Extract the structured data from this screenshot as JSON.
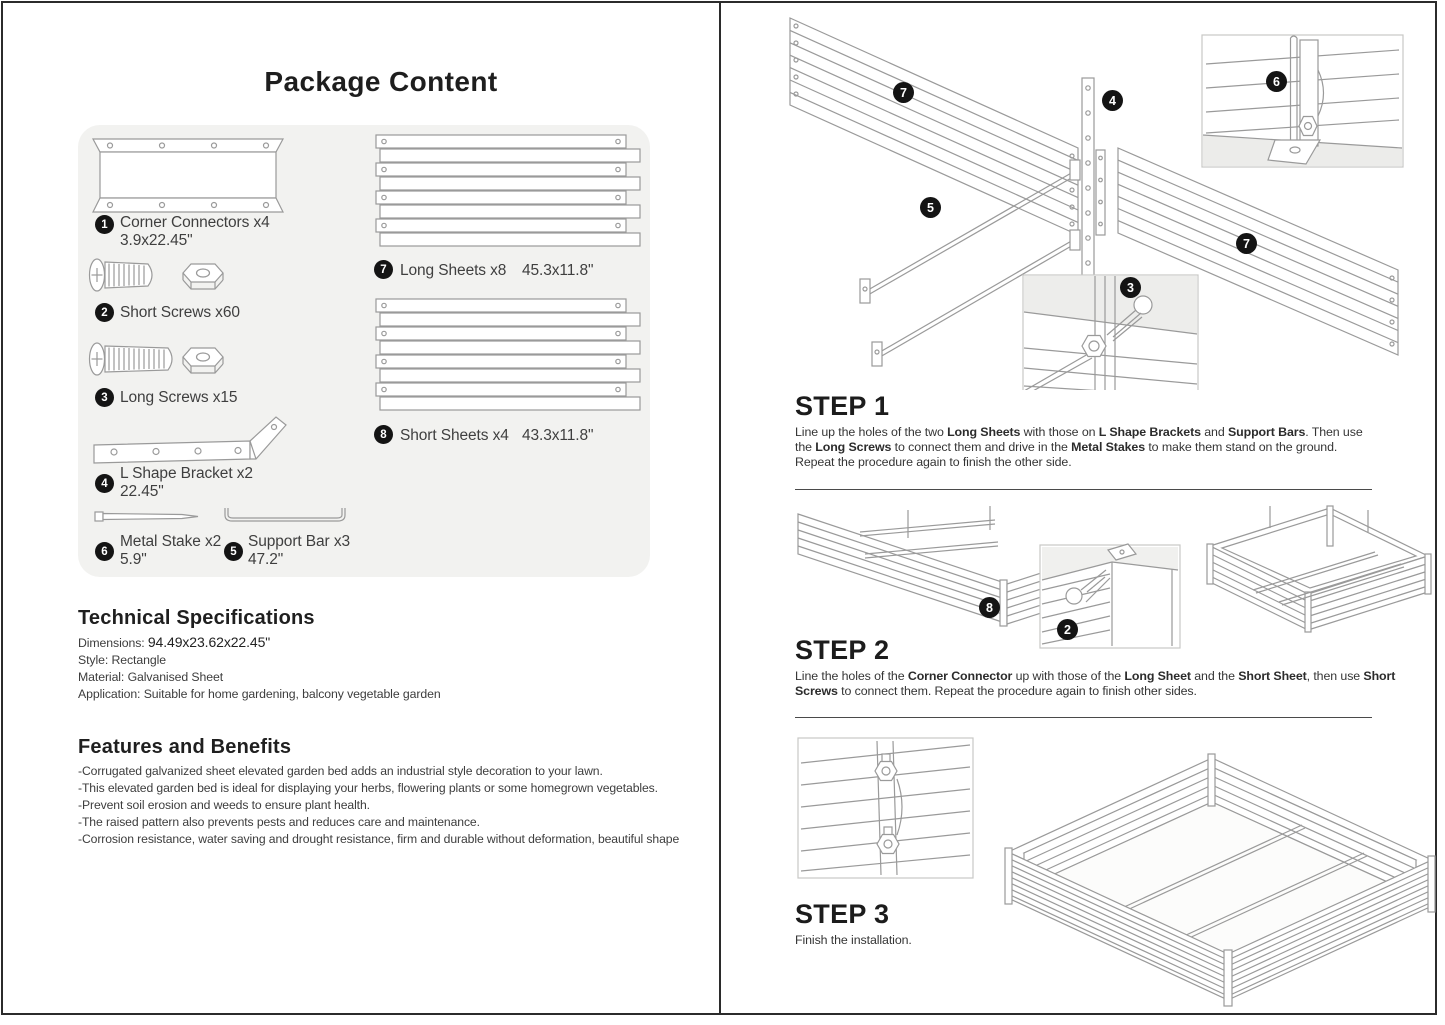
{
  "left": {
    "title": "Package Content",
    "package_items": {
      "i1": {
        "num": "1",
        "label": "Corner Connectors x4",
        "dim": "3.9x22.45\""
      },
      "i2": {
        "num": "2",
        "label": "Short Screws x60"
      },
      "i3": {
        "num": "3",
        "label": "Long Screws x15"
      },
      "i4": {
        "num": "4",
        "label": "L Shape Bracket x2",
        "dim": "22.45\""
      },
      "i5": {
        "num": "5",
        "label": "Support Bar x3",
        "dim": "47.2\""
      },
      "i6": {
        "num": "6",
        "label": "Metal Stake x2",
        "dim": "5.9\""
      },
      "i7": {
        "num": "7",
        "label": "Long Sheets x8",
        "dim": "45.3x11.8\""
      },
      "i8": {
        "num": "8",
        "label": "Short Sheets x4",
        "dim": "43.3x11.8\""
      }
    },
    "tech": {
      "heading": "Technical Specifications",
      "dimensions_label": "Dimensions: ",
      "dimensions_value": "94.49x23.62x22.45\"",
      "lines": [
        "Style: Rectangle",
        "Material: Galvanised Sheet",
        "Application: Suitable for home gardening, balcony vegetable garden"
      ]
    },
    "features": {
      "heading": "Features and Benefits",
      "bullets": [
        "-Corrugated galvanized sheet elevated garden bed adds an industrial style decoration to your lawn.",
        "-This elevated garden bed is ideal for displaying your herbs, flowering plants or some homegrown vegetables.",
        "-Prevent soil erosion and weeds to ensure plant health.",
        "-The raised pattern also prevents pests and reduces care and maintenance.",
        "-Corrosion resistance, water saving and drought resistance, firm and durable without deformation, beautiful shape"
      ]
    }
  },
  "right": {
    "step1": {
      "heading": "STEP 1",
      "body": [
        {
          "t": "Line up the holes of the two "
        },
        {
          "t": "Long Sheets",
          "b": true
        },
        {
          "t": " with those on "
        },
        {
          "t": "L Shape Brackets",
          "b": true
        },
        {
          "t": " and "
        },
        {
          "t": "Support Bars",
          "b": true
        },
        {
          "t": ". Then use the "
        },
        {
          "t": "Long Screws",
          "b": true
        },
        {
          "t": " to connect them and drive in the "
        },
        {
          "t": "Metal Stakes",
          "b": true
        },
        {
          "t": " to make them stand on the ground. Repeat the procedure again to finish the other side."
        }
      ]
    },
    "step2": {
      "heading": "STEP 2",
      "body": [
        {
          "t": "Line the holes of the "
        },
        {
          "t": "Corner Connector",
          "b": true
        },
        {
          "t": " up with those of the "
        },
        {
          "t": "Long Sheet",
          "b": true
        },
        {
          "t": " and the "
        },
        {
          "t": "Short Sheet",
          "b": true
        },
        {
          "t": ", then use "
        },
        {
          "t": "Short Screws",
          "b": true
        },
        {
          "t": " to connect them. Repeat the procedure again to finish other sides."
        }
      ]
    },
    "step3": {
      "heading": "STEP 3",
      "body": [
        {
          "t": "Finish the installation."
        }
      ]
    },
    "badges": {
      "s1_long_sheet_left": "7",
      "s1_bracket": "4",
      "s1_stake_inset": "6",
      "s1_support_bar": "5",
      "s1_long_sheet_right": "7",
      "s1_screw_inset": "3",
      "s2_assembly": "8",
      "s2_screw_inset": "2"
    }
  },
  "colors": {
    "badge": "#141414",
    "panel_background": "#f2f2f0",
    "diagram_line": "#9a9a9a",
    "page_border": "#2b2b2b"
  }
}
